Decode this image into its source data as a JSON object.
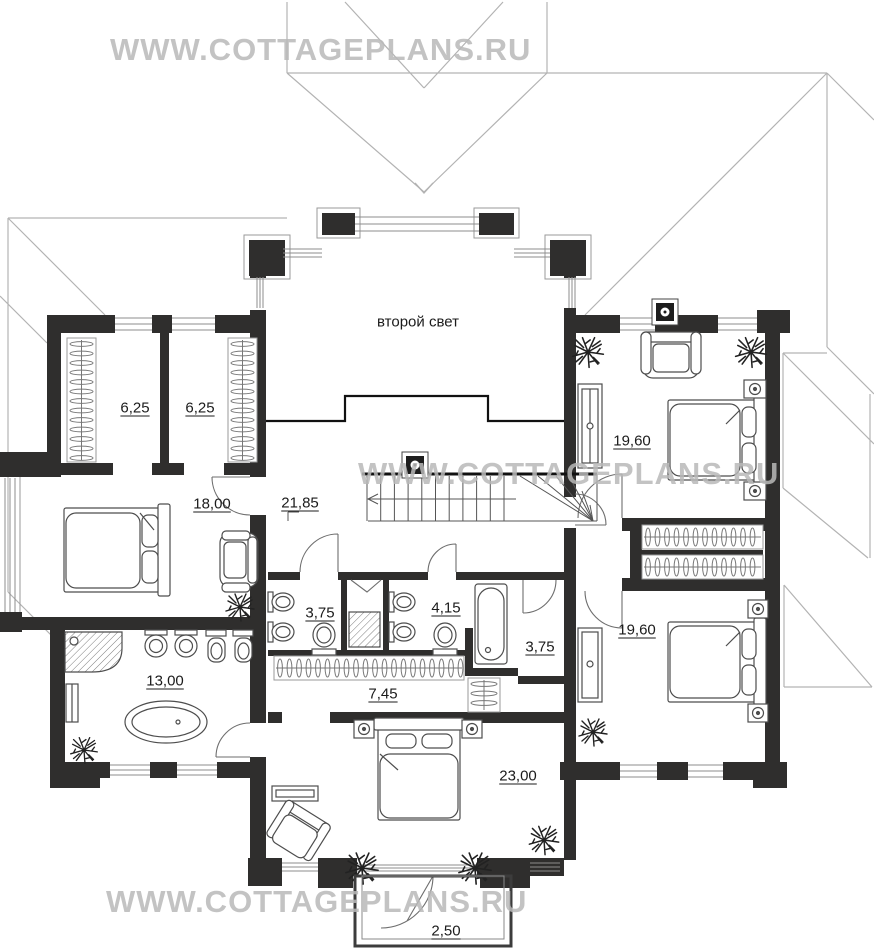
{
  "watermarks": {
    "top": "WWW.COTTAGEPLANS.RU",
    "middle": "WWW.COTTAGEPLANS.RU",
    "bottom": "WWW.COTTAGEPLANS.RU"
  },
  "plan": {
    "second_light_label": "второй свет",
    "rooms": [
      {
        "id": "closet-west-1",
        "area": "6,25"
      },
      {
        "id": "closet-west-2",
        "area": "6,25"
      },
      {
        "id": "bedroom-west",
        "area": "18,00"
      },
      {
        "id": "hall-stairs",
        "area": "21,85"
      },
      {
        "id": "bedroom-northeast",
        "area": "19,60"
      },
      {
        "id": "bathroom-left",
        "area": "3,75"
      },
      {
        "id": "bathroom-center",
        "area": "4,15"
      },
      {
        "id": "wc-right",
        "area": "3,75"
      },
      {
        "id": "master-bathroom",
        "area": "13,00"
      },
      {
        "id": "wardrobe-corridor",
        "area": "7,45"
      },
      {
        "id": "bedroom-southeast",
        "area": "19,60"
      },
      {
        "id": "master-bedroom",
        "area": "23,00"
      },
      {
        "id": "balcony",
        "area": "2,50"
      }
    ]
  },
  "colors": {
    "wall": "#2f2e2d",
    "roof_line": "#b3b3b3",
    "watermark": "#b8b8b8",
    "label_text": "#1b1b1b"
  }
}
